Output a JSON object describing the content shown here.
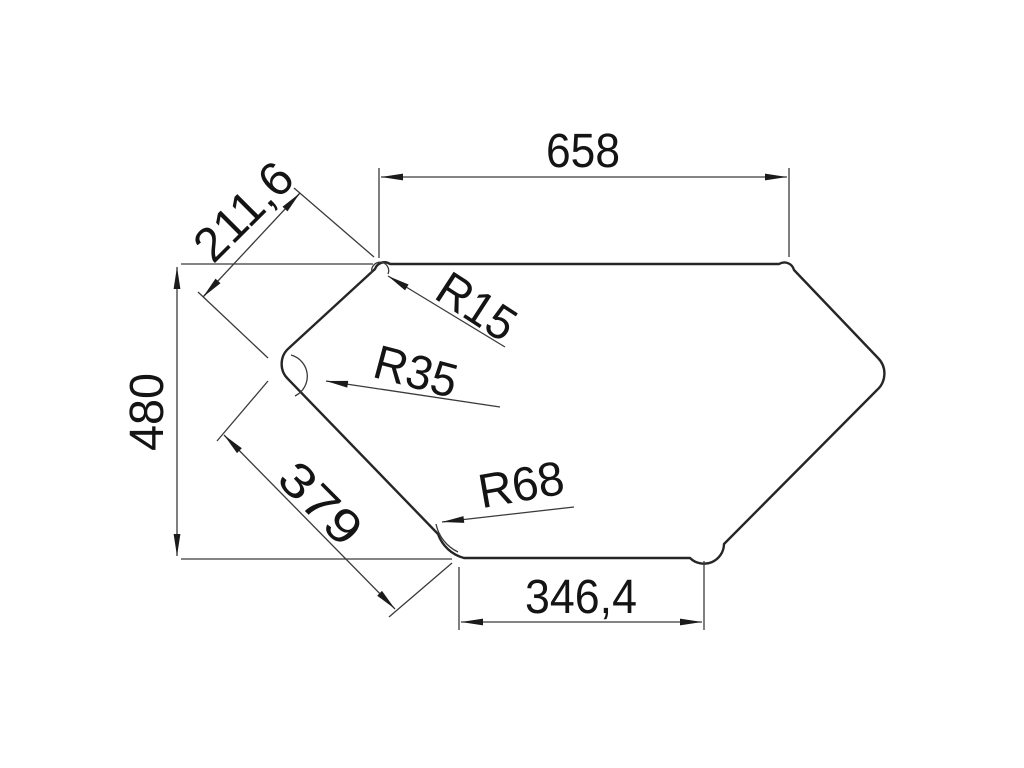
{
  "drawing": {
    "kind": "technical-dimension-drawing",
    "shape": "hexagonal outline with rounded corners"
  },
  "dimensions": {
    "top_width": "658",
    "upper_left_edge": "211,6",
    "left_height": "480",
    "lower_left_edge": "379",
    "bottom_width": "346,4"
  },
  "radii": {
    "top_left_corner": "R15",
    "left_corner": "R35",
    "bottom_left_corner": "R68"
  },
  "colors": {
    "line": "#262626",
    "dimension_line": "#3a3a3a",
    "text": "#141414",
    "background": "#ffffff"
  }
}
